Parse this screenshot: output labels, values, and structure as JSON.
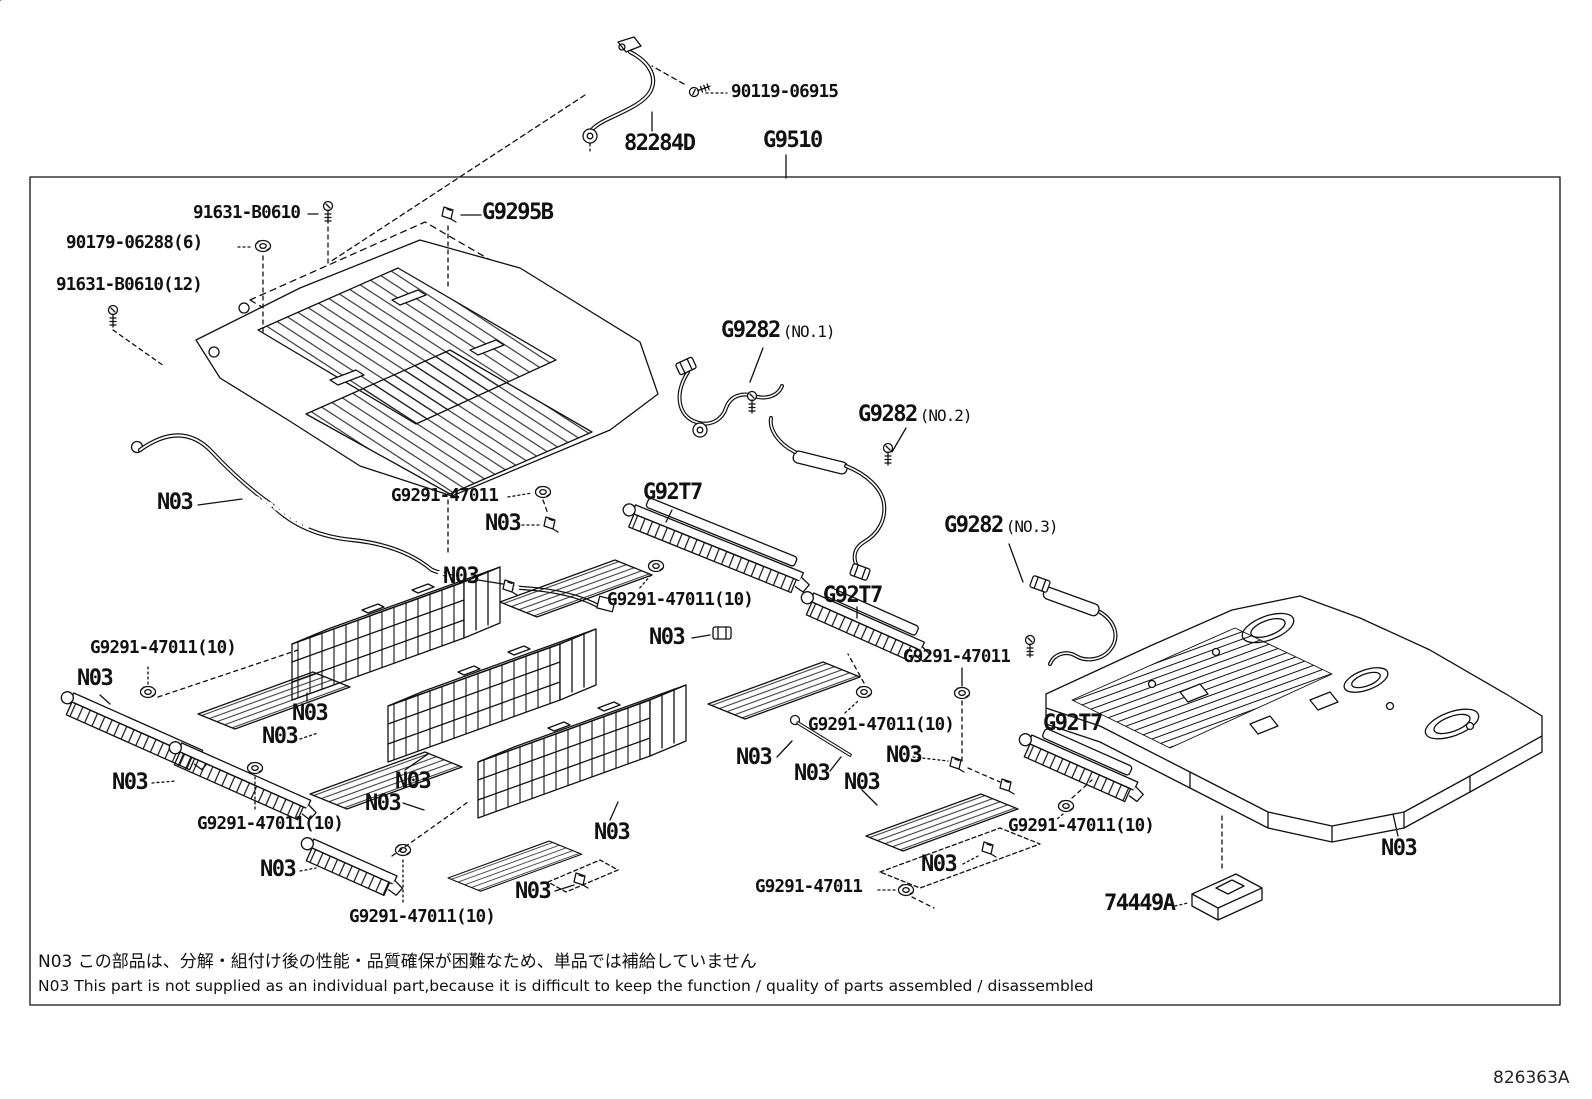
{
  "diagram": {
    "sheet_number": "826363A",
    "colors": {
      "line": "#111111",
      "background": "#ffffff"
    },
    "notes": {
      "jp": "N03 この部品は、分解・組付け後の性能・品質確保が困難なため、単品では補給していません",
      "en": "N03 This part is not supplied as an individual part,because it is difficult to keep the function / quality of parts assembled / disassembled"
    },
    "labels": [
      {
        "text": "90119-06915",
        "x": 731,
        "y": 84,
        "size": "lg"
      },
      {
        "text": "82284D",
        "x": 624,
        "y": 133,
        "size": "xl"
      },
      {
        "text": "G9510",
        "x": 763,
        "y": 130,
        "size": "xl"
      },
      {
        "text": "91631-B0610",
        "x": 193,
        "y": 205,
        "size": "lg"
      },
      {
        "text": "90179-06288(6)",
        "x": 66,
        "y": 235,
        "size": "lg"
      },
      {
        "text": "91631-B0610(12)",
        "x": 56,
        "y": 277,
        "size": "lg"
      },
      {
        "text": "G9295B",
        "x": 482,
        "y": 202,
        "size": "xl"
      },
      {
        "text": "G9282",
        "suffix": "(NO.1)",
        "x": 721,
        "y": 320,
        "size": "xl"
      },
      {
        "text": "G9282",
        "suffix": "(NO.2)",
        "x": 858,
        "y": 404,
        "size": "xl"
      },
      {
        "text": "G9282",
        "suffix": "(NO.3)",
        "x": 944,
        "y": 515,
        "size": "xl"
      },
      {
        "text": "N03",
        "x": 157,
        "y": 492,
        "size": "xl"
      },
      {
        "text": "G9291-47011",
        "x": 391,
        "y": 488,
        "size": "lg"
      },
      {
        "text": "N03",
        "x": 485,
        "y": 513,
        "size": "xl"
      },
      {
        "text": "G92T7",
        "x": 643,
        "y": 482,
        "size": "xl"
      },
      {
        "text": "N03",
        "x": 443,
        "y": 566,
        "size": "xl"
      },
      {
        "text": "G9291-47011(10)",
        "x": 607,
        "y": 592,
        "size": "lg"
      },
      {
        "text": "G92T7",
        "x": 823,
        "y": 585,
        "size": "xl"
      },
      {
        "text": "N03",
        "x": 649,
        "y": 627,
        "size": "xl"
      },
      {
        "text": "G9291-47011",
        "x": 903,
        "y": 649,
        "size": "lg"
      },
      {
        "text": "G9291-47011(10)",
        "x": 90,
        "y": 640,
        "size": "lg"
      },
      {
        "text": "N03",
        "x": 77,
        "y": 668,
        "size": "xl"
      },
      {
        "text": "N03",
        "x": 292,
        "y": 703,
        "size": "xl"
      },
      {
        "text": "N03",
        "x": 262,
        "y": 726,
        "size": "xl"
      },
      {
        "text": "G92T7",
        "x": 1043,
        "y": 713,
        "size": "xl"
      },
      {
        "text": "G9291-47011(10)",
        "x": 808,
        "y": 717,
        "size": "lg"
      },
      {
        "text": "N03",
        "x": 736,
        "y": 747,
        "size": "xl"
      },
      {
        "text": "N03",
        "x": 794,
        "y": 763,
        "size": "xl"
      },
      {
        "text": "N03",
        "x": 844,
        "y": 772,
        "size": "xl"
      },
      {
        "text": "N03",
        "x": 886,
        "y": 745,
        "size": "xl"
      },
      {
        "text": "N03",
        "x": 112,
        "y": 772,
        "size": "xl"
      },
      {
        "text": "N03",
        "x": 395,
        "y": 771,
        "size": "xl"
      },
      {
        "text": "N03",
        "x": 365,
        "y": 793,
        "size": "xl"
      },
      {
        "text": "G9291-47011(10)",
        "x": 197,
        "y": 816,
        "size": "lg"
      },
      {
        "text": "N03",
        "x": 594,
        "y": 822,
        "size": "xl"
      },
      {
        "text": "N03",
        "x": 260,
        "y": 859,
        "size": "xl"
      },
      {
        "text": "G9291-47011(10)",
        "x": 349,
        "y": 909,
        "size": "lg"
      },
      {
        "text": "N03",
        "x": 515,
        "y": 881,
        "size": "xl"
      },
      {
        "text": "N03",
        "x": 921,
        "y": 854,
        "size": "xl"
      },
      {
        "text": "G9291-47011",
        "x": 755,
        "y": 879,
        "size": "lg"
      },
      {
        "text": "G9291-47011(10)",
        "x": 1008,
        "y": 818,
        "size": "lg"
      },
      {
        "text": "74449A",
        "x": 1104,
        "y": 893,
        "size": "xl"
      },
      {
        "text": "N03",
        "x": 1381,
        "y": 838,
        "size": "xl"
      }
    ]
  }
}
